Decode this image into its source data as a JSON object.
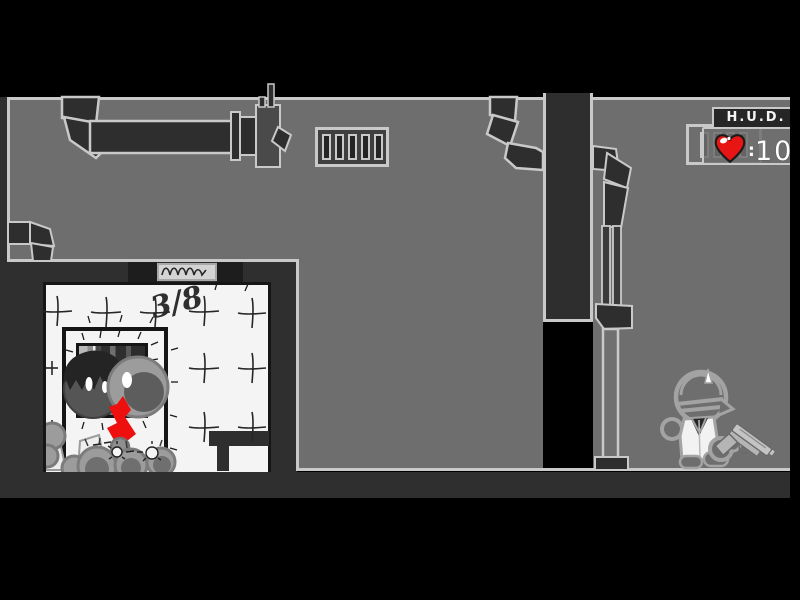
{
  "hud": {
    "panel_title": "H.U.D.",
    "health_separator": ":",
    "health_value": "100",
    "heart_color": "#e81515"
  },
  "scene": {
    "tally_marking": "3/8",
    "icons": {
      "plaque_scribble": "illegible-handwritten-scribble",
      "heart": "health-heart"
    },
    "colors": {
      "background": "#000000",
      "wall_gray": "#6e6e6e",
      "outline_light": "#c9c9c9",
      "structure_dark": "#2e2e2e",
      "room_white": "#f4f4f4",
      "blood_red": "#ee0f0f",
      "heart_red": "#e81515"
    }
  }
}
